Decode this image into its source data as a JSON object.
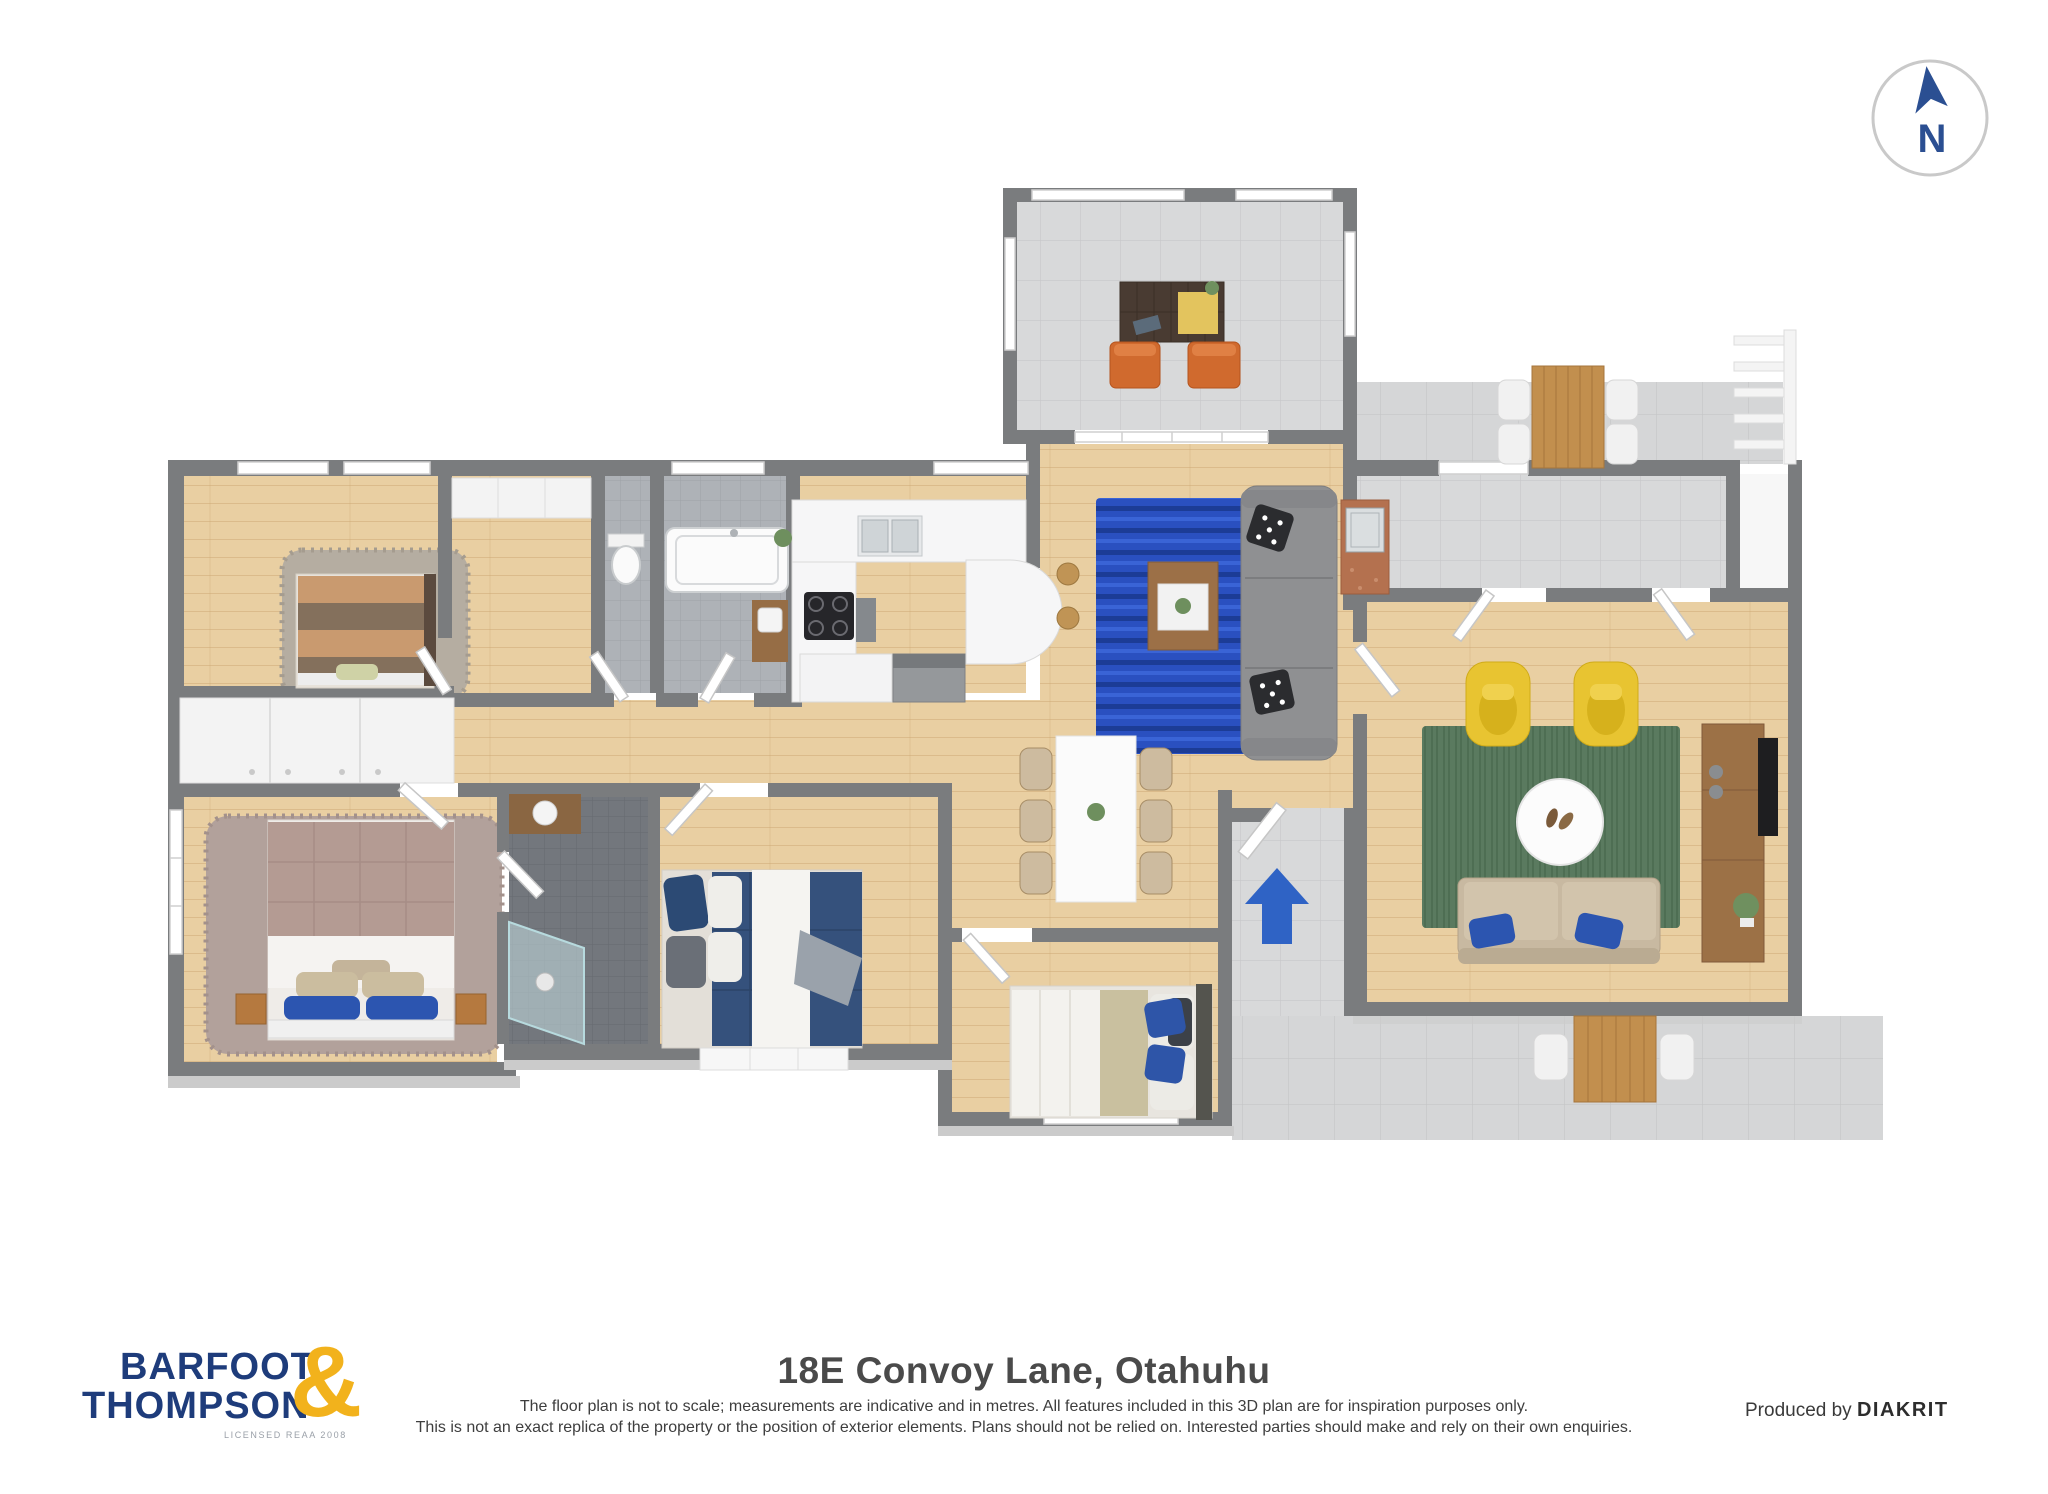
{
  "meta": {
    "kind": "3d-floor-plan-marketing-sheet"
  },
  "compass": {
    "label": "N"
  },
  "branding": {
    "logo_line1": "BARFOOT",
    "logo_line2": "THOMPSON",
    "logo_ampersand": "&",
    "logo_tagline": "LICENSED REAA 2008"
  },
  "footer": {
    "title": "18E Convoy Lane, Otahuhu",
    "disclaimer_line1": "The floor plan is not to scale; measurements are indicative and in metres. All features included in this 3D plan are for inspiration purposes only.",
    "disclaimer_line2": "This is not an exact replica of the property or the position of exterior elements. Plans should not be relied on. Interested parties should make and rely on their own enquiries.",
    "produced_by_prefix": "Produced by",
    "produced_by_brand": "DIAKRIT"
  },
  "colors": {
    "wall": "#7a7c7e",
    "wood_floor": "#e9cfa2",
    "tile_floor": "#d8d9da",
    "bath_tile": "#aeb2b7",
    "ensuite_tile": "#75797f",
    "rug_blue": "#2a50c0",
    "rug_green": "#5a7a5f",
    "sofa_gray": "#8f9092",
    "sofa_beige": "#c8b9a1",
    "armchair_yellow": "#e8c431",
    "chair_orange": "#d06a2e",
    "entry_arrow_blue": "#2f63c5",
    "logo_navy": "#1e3c7b",
    "logo_gold": "#f2b21c",
    "compass_blue": "#2b4f92"
  },
  "rooms": [
    "sunroom",
    "living-room",
    "kitchen",
    "bathroom",
    "toilet",
    "hallway",
    "bedroom-1",
    "master-bedroom",
    "ensuite",
    "bedroom-2",
    "bedroom-3",
    "dining-area",
    "entry",
    "laundry",
    "family-room",
    "deck",
    "patio"
  ]
}
